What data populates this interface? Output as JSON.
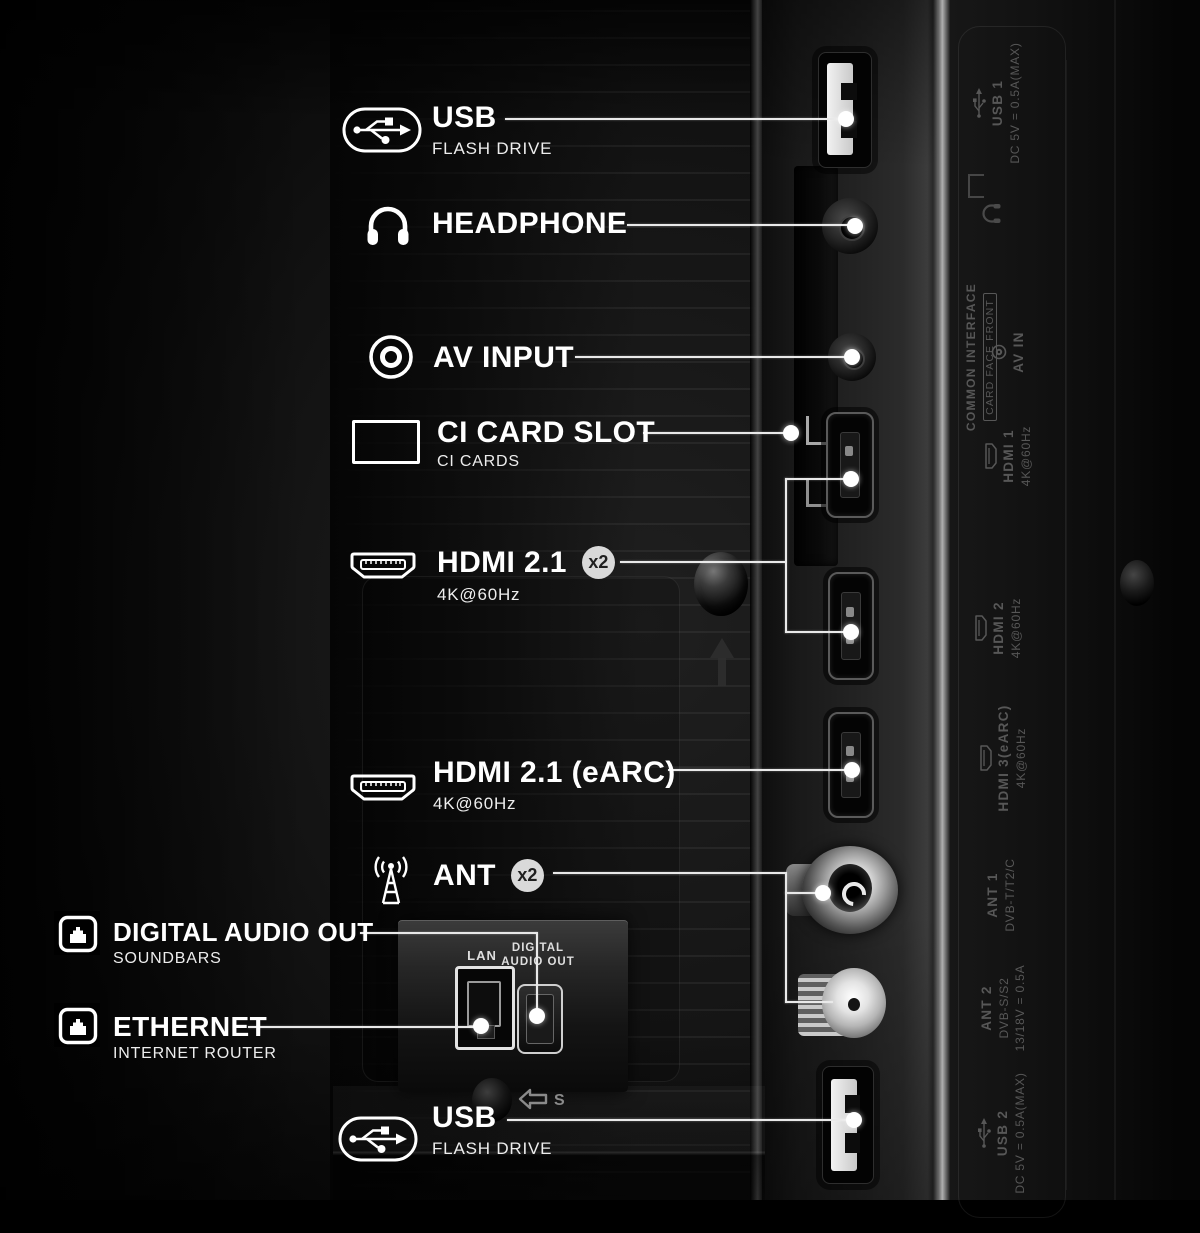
{
  "callouts": [
    {
      "id": "usb_top",
      "title": "USB",
      "subtitle": "FLASH DRIVE",
      "icon": "usb-icon"
    },
    {
      "id": "headphone",
      "title": "HEADPHONE",
      "subtitle": "",
      "icon": "headphone-icon"
    },
    {
      "id": "av_input",
      "title": "AV INPUT",
      "subtitle": "",
      "icon": "av-input-icon"
    },
    {
      "id": "ci_card_slot",
      "title": "CI CARD SLOT",
      "subtitle": "CI CARDS",
      "icon": "ci-card-icon"
    },
    {
      "id": "hdmi_2_1",
      "title": "HDMI 2.1",
      "subtitle": "4K@60Hz",
      "badge": "x2",
      "icon": "hdmi-icon"
    },
    {
      "id": "hdmi_2_1_earc",
      "title": "HDMI 2.1 (eARC)",
      "subtitle": "4K@60Hz",
      "icon": "hdmi-icon"
    },
    {
      "id": "ant",
      "title": "ANT",
      "subtitle": "",
      "badge": "x2",
      "icon": "antenna-icon"
    },
    {
      "id": "digital_audio_out",
      "title": "DIGITAL AUDIO OUT",
      "subtitle": "SOUNDBARS",
      "icon": "ethernet-jack-icon"
    },
    {
      "id": "ethernet",
      "title": "ETHERNET",
      "subtitle": "INTERNET ROUTER",
      "icon": "ethernet-jack-icon"
    },
    {
      "id": "usb_bottom",
      "title": "USB",
      "subtitle": "FLASH DRIVE",
      "icon": "usb-icon"
    }
  ],
  "bay": {
    "lan_label": "LAN",
    "optical_line1": "DIGITAL",
    "optical_line2": "AUDIO OUT"
  },
  "engraved": [
    {
      "name": "USB 1",
      "spec": "DC 5V = 0.5A(MAX)",
      "icon": "usb"
    },
    {
      "name": "COMMON INTERFACE",
      "boxed": "CARD FACE FRONT"
    },
    {
      "name": "AV IN",
      "icon": "av-circle"
    },
    {
      "name": "HDMI 1",
      "spec": "4K@60Hz",
      "icon": "hdmi"
    },
    {
      "name": "HDMI 2",
      "spec": "4K@60Hz",
      "icon": "hdmi"
    },
    {
      "name": "HDMI 3(eARC)",
      "spec": "4K@60Hz",
      "icon": "hdmi"
    },
    {
      "name": "ANT 1",
      "spec": "DVB-T/T2/C"
    },
    {
      "name": "ANT 2",
      "spec": "DVB-S/S2",
      "spec2": "13/18V = 0.5A"
    },
    {
      "name": "USB 2",
      "spec": "DC 5V = 0.5A(MAX)",
      "icon": "usb"
    }
  ],
  "markers": {
    "s_label": "S"
  },
  "colors": {
    "background": "#000000",
    "label_text": "#ffffff",
    "line": "#e9e9e9",
    "badge_bg": "#d9d9d9",
    "badge_text": "#1f1f1f",
    "engraved": "#575757",
    "port_label": "#dedede"
  }
}
